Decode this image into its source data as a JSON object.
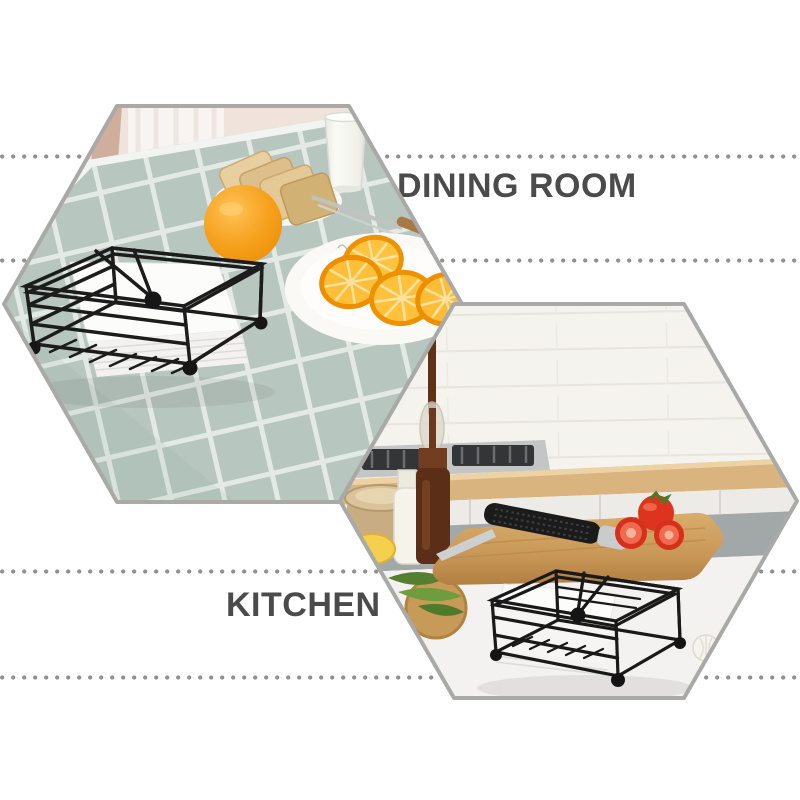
{
  "labels": {
    "dining": "DINING ROOM",
    "kitchen": "KITCHEN"
  },
  "colors": {
    "page_background": "#ffffff",
    "label_text": "#4b4b4b",
    "dotted_line": "#8f8f8f",
    "hexagon_border": "#a9aaa8",
    "tablecloth": "#b7c6bf",
    "tablecloth_grid": "#e3eae5",
    "orange_fruit": "#f29409",
    "toast": "#dcbe8c",
    "napkin_holder_wire": "#1c1c1c",
    "napkin": "#fbfbfa",
    "tile_wall": "#f4f3ee",
    "counter_wood": "#d9b47e",
    "cabinet_gray": "#a2a7a8",
    "cutting_board": "#c89757",
    "tomato": "#dd3420"
  },
  "scenes": {
    "dining": {
      "name": "dining room scene",
      "items": [
        "napkin holder with napkins",
        "orange",
        "plate of toast",
        "glass of milk",
        "plate of orange slices",
        "knife and fork",
        "checkered tablecloth",
        "curtain"
      ]
    },
    "kitchen": {
      "name": "kitchen scene",
      "items": [
        "napkin holder with napkins",
        "cutting board",
        "knife",
        "tomatoes",
        "oil dropper bottle",
        "milk bottle",
        "burlap sack",
        "gas stove",
        "lemon",
        "herb leaves",
        "garlic"
      ]
    }
  }
}
